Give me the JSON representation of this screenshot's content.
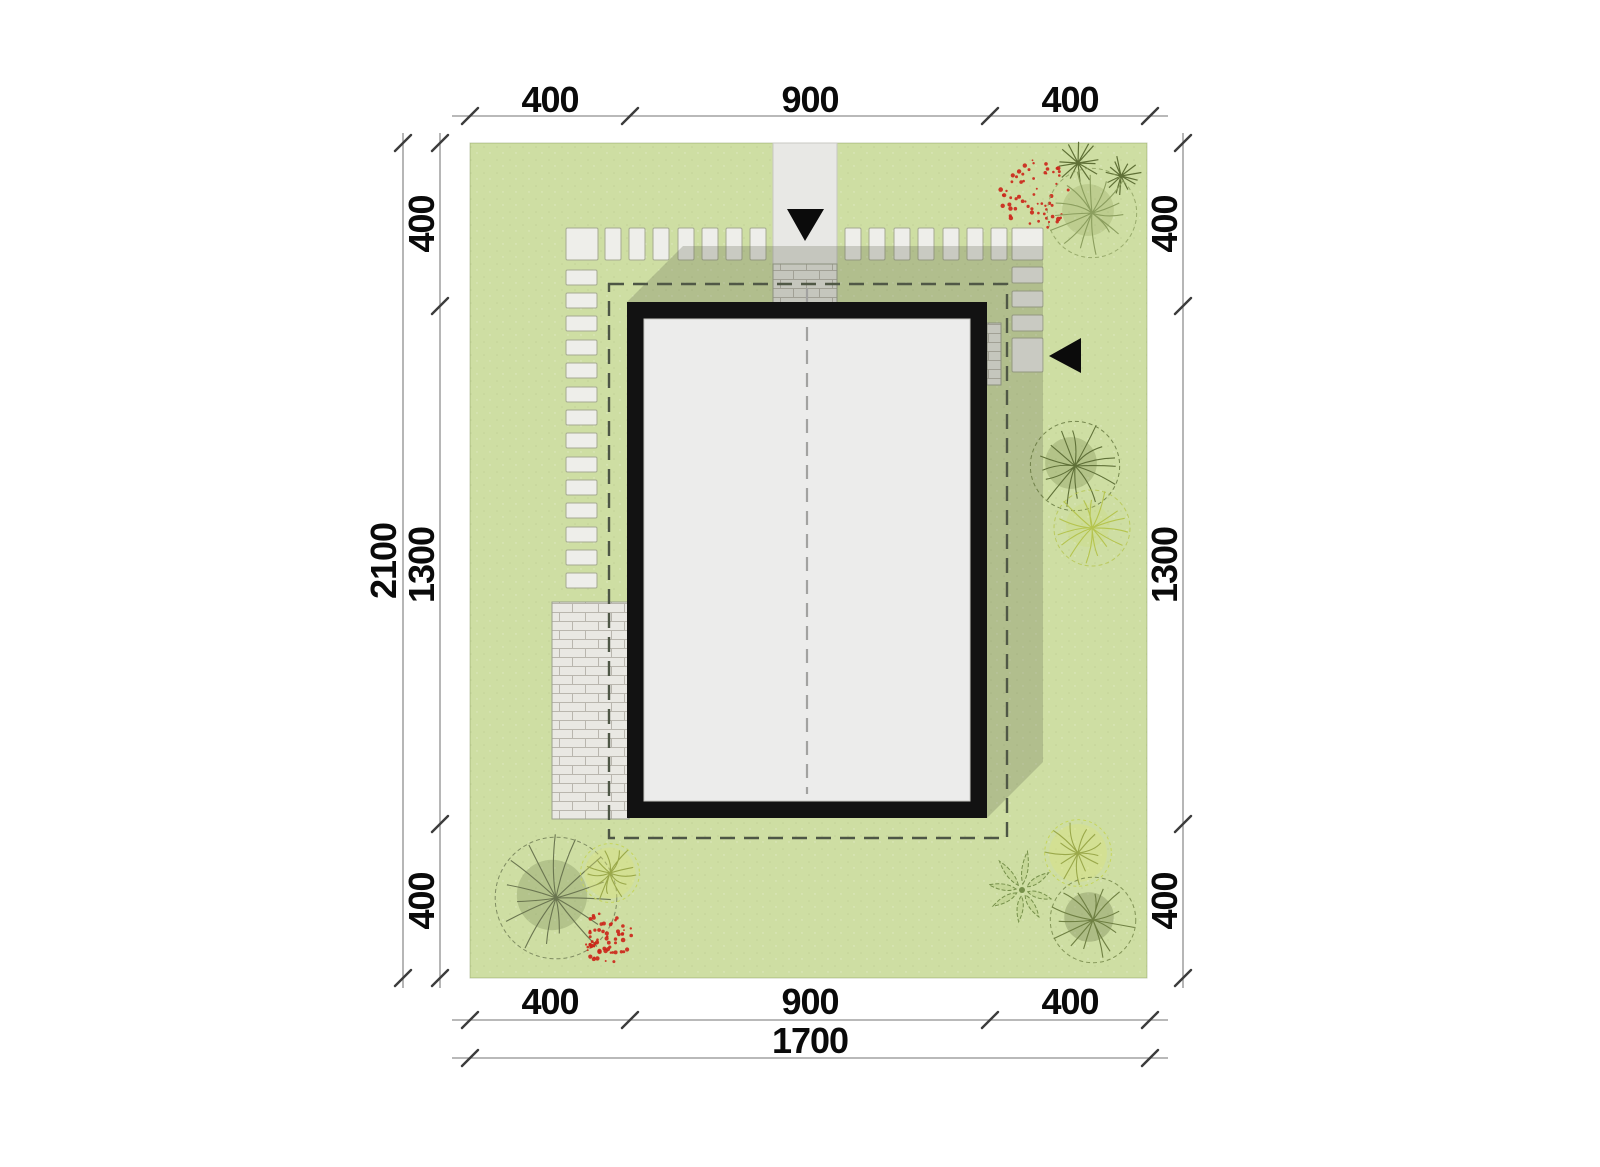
{
  "drawing": {
    "type": "architectural site plan",
    "view": "top-down plot plan with building footprint, paths, vegetation and dimension chains"
  },
  "colors": {
    "grass": "#cedea3",
    "paving": "#e8e8e5",
    "stone": "#eeeeea",
    "shadow": "rgba(90,96,74,0.25)",
    "setback_dash": "#4d5645",
    "building_outline": "#121212",
    "roof": "#ececeb",
    "dim_line": "#8f8f8f",
    "dim_text": "#0a0a0a",
    "berry_red": "#cc2418"
  },
  "dimensions": {
    "top": {
      "segments": [
        "400",
        "900",
        "400"
      ]
    },
    "bottom": {
      "segments": [
        "400",
        "900",
        "400"
      ],
      "total": "1700"
    },
    "left": {
      "total": "2100",
      "segments": [
        "400",
        "1300",
        "400"
      ]
    },
    "right": {
      "segments": [
        "400",
        "1300",
        "400"
      ]
    }
  },
  "markers": {
    "driveway_arrow": "down-arrow",
    "entrance_arrow": "left-arrow"
  },
  "stones": {
    "top_corner": [
      [
        566,
        228,
        32,
        32
      ],
      [
        1012,
        228,
        31,
        32
      ]
    ],
    "top_row": [
      [
        605,
        228,
        16,
        32
      ],
      [
        629,
        228,
        16,
        32
      ],
      [
        653,
        228,
        16,
        32
      ],
      [
        678,
        228,
        16,
        32
      ],
      [
        702,
        228,
        16,
        32
      ],
      [
        726,
        228,
        16,
        32
      ],
      [
        750,
        228,
        16,
        32
      ],
      [
        845,
        228,
        16,
        32
      ],
      [
        869,
        228,
        16,
        32
      ],
      [
        894,
        228,
        16,
        32
      ],
      [
        918,
        228,
        16,
        32
      ],
      [
        943,
        228,
        16,
        32
      ],
      [
        967,
        228,
        16,
        32
      ],
      [
        991,
        228,
        16,
        32
      ]
    ],
    "left_column": [
      [
        566,
        270,
        31,
        15
      ],
      [
        566,
        293,
        31,
        15
      ],
      [
        566,
        316,
        31,
        15
      ],
      [
        566,
        340,
        31,
        15
      ],
      [
        566,
        363,
        31,
        15
      ],
      [
        566,
        387,
        31,
        15
      ],
      [
        566,
        410,
        31,
        15
      ],
      [
        566,
        433,
        31,
        15
      ],
      [
        566,
        457,
        31,
        15
      ],
      [
        566,
        480,
        31,
        15
      ],
      [
        566,
        503,
        31,
        15
      ],
      [
        566,
        527,
        31,
        15
      ],
      [
        566,
        550,
        31,
        15
      ],
      [
        566,
        573,
        31,
        15
      ]
    ],
    "right_column": [
      [
        1012,
        267,
        31,
        16
      ],
      [
        1012,
        291,
        31,
        16
      ],
      [
        1012,
        315,
        31,
        16
      ],
      [
        1012,
        338,
        31,
        34
      ]
    ]
  },
  "vegetation": [
    {
      "name": "red-shrub-top-right",
      "type": "red-bush",
      "cx": 1036,
      "cy": 196,
      "r": 36
    },
    {
      "name": "palm-plant-top-right-1",
      "type": "palm",
      "cx": 1078,
      "cy": 163,
      "r": 23
    },
    {
      "name": "palm-plant-top-right-2",
      "type": "palm",
      "cx": 1121,
      "cy": 176,
      "r": 20
    },
    {
      "name": "tree-top-right",
      "type": "round",
      "cx": 1092,
      "cy": 213,
      "r": 47,
      "stroke": "#8b9e5e",
      "fill": "rgba(150,165,100,0.30)"
    },
    {
      "name": "tree-right-middle",
      "type": "round",
      "cx": 1075,
      "cy": 466,
      "r": 47,
      "stroke": "#5f7038",
      "fill": "rgba(120,140,80,0.32)"
    },
    {
      "name": "tree-right-lower",
      "type": "round",
      "cx": 1092,
      "cy": 528,
      "r": 40,
      "stroke": "#b5c44e",
      "fill": "rgba(205,220,110,0.22)"
    },
    {
      "name": "tree-bottom-left",
      "type": "round",
      "cx": 556,
      "cy": 898,
      "r": 64,
      "stroke": "#6a7550",
      "fill": "rgba(130,145,95,0.35)"
    },
    {
      "name": "shrub-bottom-left-yellow",
      "type": "yellow-bush",
      "cx": 610,
      "cy": 873,
      "r": 30
    },
    {
      "name": "red-shrub-bottom-left",
      "type": "red-bush",
      "cx": 607,
      "cy": 937,
      "r": 26
    },
    {
      "name": "plant-bottom-right-leafy",
      "type": "leafy",
      "cx": 1022,
      "cy": 890,
      "r": 36
    },
    {
      "name": "tree-bottom-right-light",
      "type": "yellow-bush",
      "cx": 1078,
      "cy": 853,
      "r": 34
    },
    {
      "name": "tree-bottom-right",
      "type": "round",
      "cx": 1093,
      "cy": 920,
      "r": 45,
      "stroke": "#6e7f42",
      "fill": "rgba(120,135,85,0.38)"
    }
  ]
}
